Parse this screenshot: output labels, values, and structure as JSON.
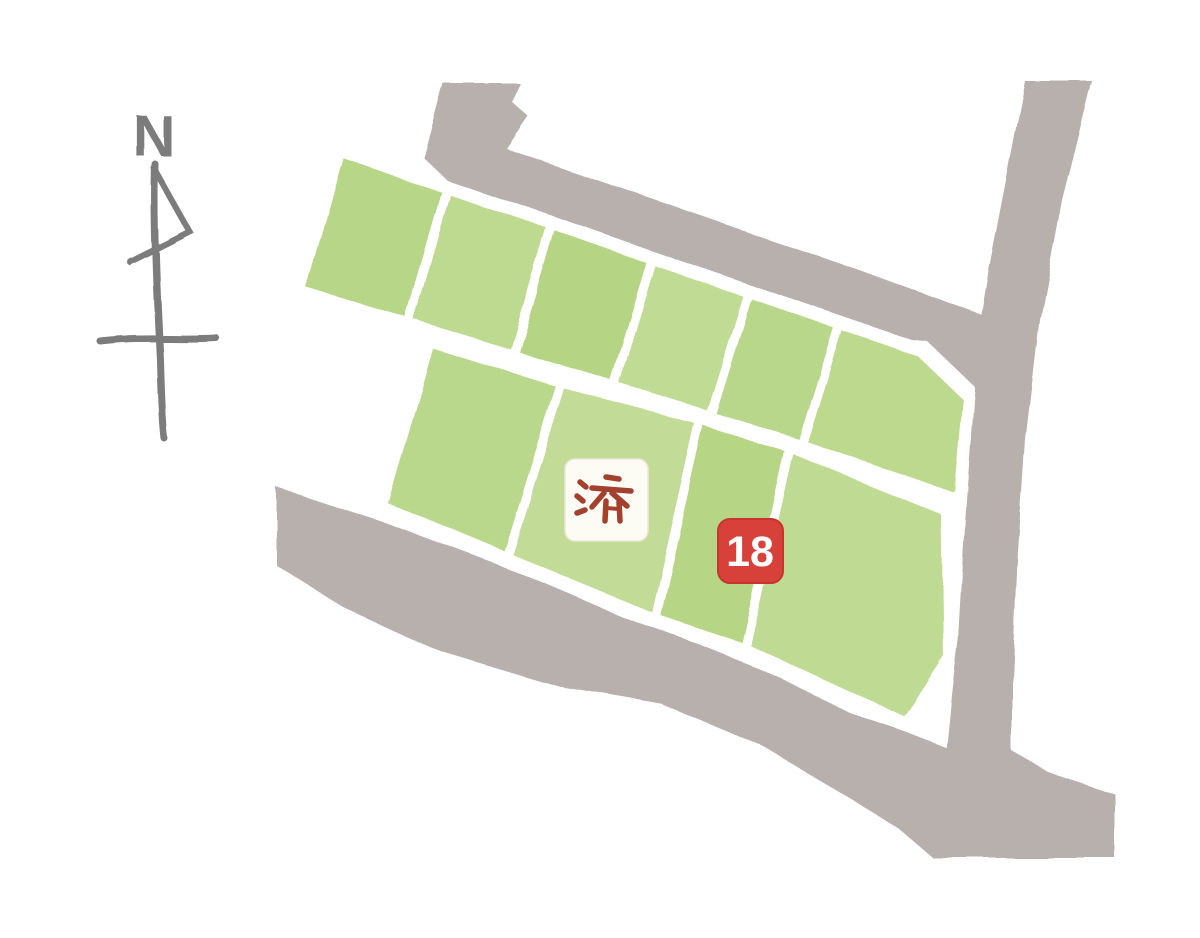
{
  "map": {
    "compass": {
      "label": "N"
    },
    "sold_badge": {
      "text": "済"
    },
    "number_badge": {
      "text": "18"
    },
    "plots": {
      "top_row": [
        {
          "id": "top-1",
          "badge": ""
        },
        {
          "id": "top-2",
          "badge": ""
        },
        {
          "id": "top-3",
          "badge": ""
        },
        {
          "id": "top-4",
          "badge": ""
        },
        {
          "id": "top-5",
          "badge": ""
        },
        {
          "id": "top-6",
          "badge": ""
        }
      ],
      "bottom_row": [
        {
          "id": "bottom-1",
          "badge": ""
        },
        {
          "id": "bottom-2",
          "badge": "済"
        },
        {
          "id": "bottom-3",
          "badge": "18"
        },
        {
          "id": "bottom-4",
          "badge": ""
        }
      ]
    },
    "colors": {
      "background": "#ffffff",
      "road_gray": "#b7b0ac",
      "road_gray_light": "#beb8b4",
      "plot_fills": [
        "#b7d687",
        "#bed990",
        "#b5d584",
        "#c0db94",
        "#b8d78a",
        "#bdd98e",
        "#bad88c",
        "#c2dc97",
        "#b6d685",
        "#bfda92"
      ],
      "plot_border": "#ffffff",
      "sold_badge_bg": "#fdfcf4",
      "sold_badge_text": "#a3402e",
      "number_badge_bg": "#d8413a",
      "number_badge_border": "#c4362f",
      "number_badge_text": "#ffffff",
      "compass": "#7c7c7c"
    }
  }
}
